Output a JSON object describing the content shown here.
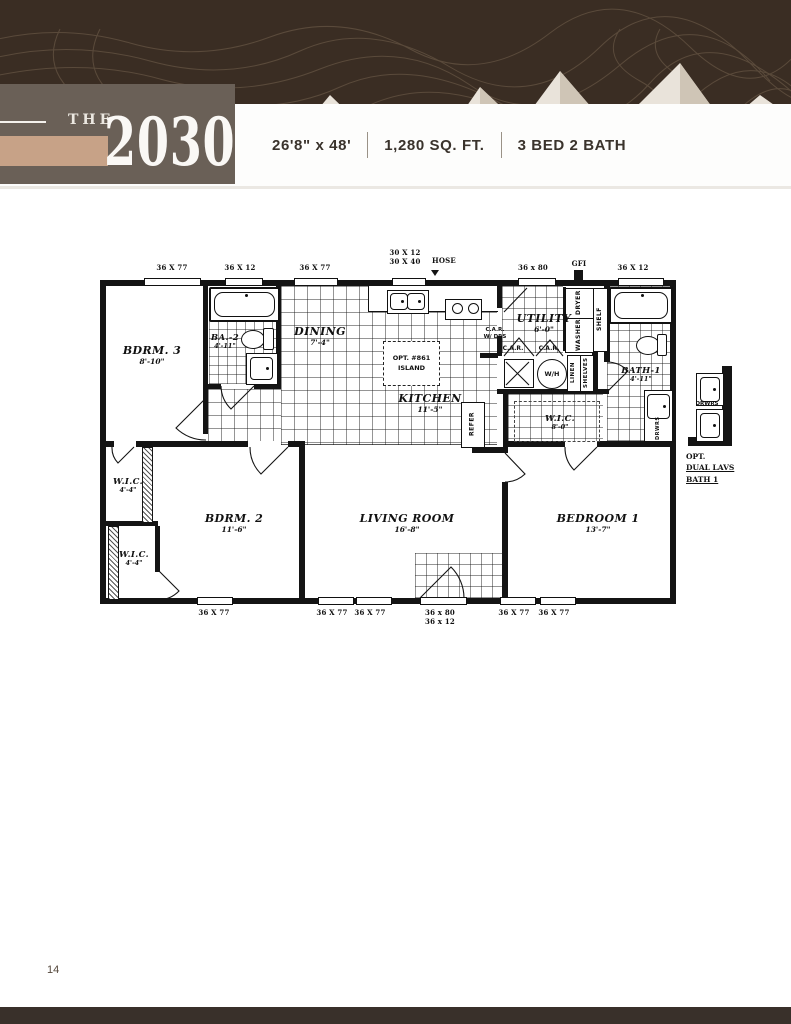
{
  "header": {
    "series_label": "THE",
    "model_number": "2030",
    "specs": {
      "dimensions": "26'8\" x 48'",
      "area": "1,280 SQ. FT.",
      "beds_baths": "3 BED 2 BATH"
    }
  },
  "plan": {
    "rooms": {
      "bdrm3": {
        "name": "BDRM. 3",
        "dim": "8'-10\""
      },
      "ba2": {
        "name": "BA.-2",
        "dim": "4'-11\""
      },
      "dining": {
        "name": "DINING",
        "dim": "7'-4\""
      },
      "kitchen": {
        "name": "KITCHEN",
        "dim": "11'-5\""
      },
      "utility": {
        "name": "UTILITY",
        "dim": "6'-0\""
      },
      "bath1": {
        "name": "BATH-1",
        "dim": "4'-11\""
      },
      "wic_hall": {
        "name": "W.I.C.",
        "dim": "8'-0\""
      },
      "wic_upper": {
        "name": "W.I.C.",
        "dim": "4'-4\""
      },
      "wic_lower": {
        "name": "W.I.C.",
        "dim": "4'-4\""
      },
      "bdrm2": {
        "name": "BDRM. 2",
        "dim": "11'-6\""
      },
      "living": {
        "name": "LIVING ROOM",
        "dim": "16'-8\""
      },
      "bedroom1": {
        "name": "BEDROOM 1",
        "dim": "13'-7\""
      }
    },
    "win_top": [
      "36 X 77",
      "36 X 12",
      "36 X 77",
      "30 X 12",
      "30 X 40",
      "36 x 80",
      "36 X 12"
    ],
    "hose_label": "HOSE",
    "gfi_label": "GFI",
    "win_bottom": [
      "36 X 77",
      "36 X 77",
      "36 X 77",
      "36 x 80",
      "36 x 12",
      "36 X 77",
      "36 X 77"
    ],
    "fixtures": {
      "island_line1": "OPT. #861",
      "island_line2": "ISLAND",
      "refer": "REFER",
      "dryer": "DRYER",
      "washer": "WASHER",
      "shelf": "SHELF",
      "linen": "LINEN",
      "shelves": "SHELVES",
      "water_heater": "W/H",
      "car": "C.A.R.",
      "car_wdrs_line1": "C.A.R.",
      "car_wdrs_line2": "W/ DRS",
      "drwrs": "DRWRS"
    },
    "detail": {
      "drwrs": "DRWRS",
      "caption_line1": "OPT.",
      "caption_line2": "DUAL LAVS",
      "caption_line3": "BATH 1"
    }
  },
  "footer": {
    "page_number": "14"
  },
  "colors": {
    "banner_brown": "#3a2d23",
    "contour_line": "#75634f",
    "mountain_light": "#e9e3da",
    "mountain_mid": "#d9cfc2",
    "title_block": "#6a6057",
    "accent_tan": "#c7a287",
    "ink": "#141414",
    "spec_text": "#3a332c"
  }
}
